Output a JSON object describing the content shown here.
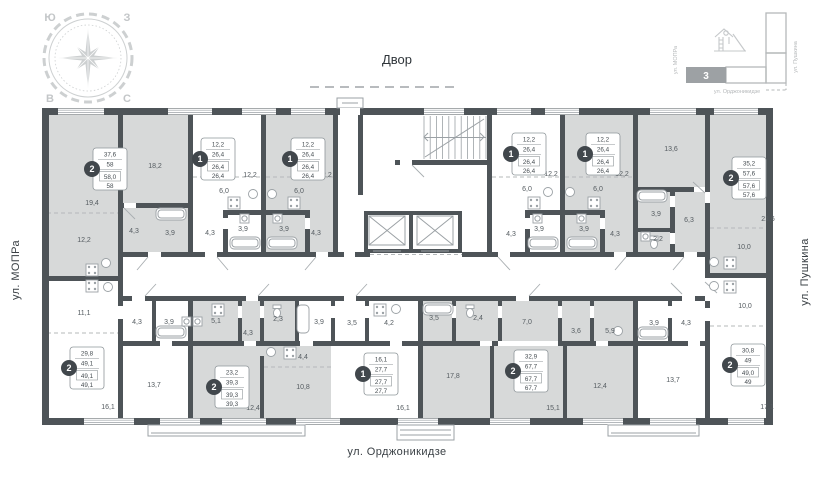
{
  "colors": {
    "wall": "#4e5458",
    "room_highlight": "#d7d9d9",
    "fixture_line": "#9ba1a5",
    "label_text": "#555c61",
    "accent_dark": "#41474c",
    "compass": "#cdd0d1",
    "minimap_fill": "#9da1a4"
  },
  "compass": {
    "nw": "Ю",
    "ne": "З",
    "sw": "В",
    "se": "С"
  },
  "labels": {
    "courtyard": "Двор",
    "street_left": "ул. МОПРа",
    "street_right": "ул. Пушкина",
    "street_bottom": "ул. Орджоникидзе"
  },
  "site_map": {
    "section_number": "3",
    "street_left": "ул. МОПРа",
    "street_right": "ул. Пушкина",
    "street_bottom": "ул. Орджоникидзе"
  },
  "plan": {
    "room_labels": [
      {
        "t": "19,4",
        "x": 92,
        "y": 205
      },
      {
        "t": "12,2",
        "x": 84,
        "y": 242
      },
      {
        "t": "18,2",
        "x": 155,
        "y": 168
      },
      {
        "t": "4,3",
        "x": 134,
        "y": 233
      },
      {
        "t": "3,9",
        "x": 170,
        "y": 235
      },
      {
        "t": "12,2",
        "x": 250,
        "y": 177
      },
      {
        "t": "6,0",
        "x": 224,
        "y": 193
      },
      {
        "t": "4,3",
        "x": 210,
        "y": 235
      },
      {
        "t": "3,9",
        "x": 243,
        "y": 231
      },
      {
        "t": "12,2",
        "x": 325,
        "y": 177
      },
      {
        "t": "6,0",
        "x": 299,
        "y": 193
      },
      {
        "t": "3,9",
        "x": 284,
        "y": 231
      },
      {
        "t": "4,3",
        "x": 316,
        "y": 235
      },
      {
        "t": "12,2",
        "x": 551,
        "y": 176
      },
      {
        "t": "6,0",
        "x": 527,
        "y": 191
      },
      {
        "t": "4,3",
        "x": 511,
        "y": 236
      },
      {
        "t": "3,9",
        "x": 539,
        "y": 231
      },
      {
        "t": "12,2",
        "x": 622,
        "y": 176
      },
      {
        "t": "6,0",
        "x": 598,
        "y": 191
      },
      {
        "t": "3,9",
        "x": 584,
        "y": 231
      },
      {
        "t": "4,3",
        "x": 615,
        "y": 236
      },
      {
        "t": "13,6",
        "x": 671,
        "y": 151
      },
      {
        "t": "3,9",
        "x": 656,
        "y": 216
      },
      {
        "t": "6,3",
        "x": 689,
        "y": 222
      },
      {
        "t": "2,2",
        "x": 658,
        "y": 241
      },
      {
        "t": "21,6",
        "x": 768,
        "y": 221
      },
      {
        "t": "10,0",
        "x": 744,
        "y": 249
      },
      {
        "t": "11,1",
        "x": 84,
        "y": 315
      },
      {
        "t": "4,3",
        "x": 137,
        "y": 324
      },
      {
        "t": "3,9",
        "x": 169,
        "y": 324
      },
      {
        "t": "5,1",
        "x": 216,
        "y": 323
      },
      {
        "t": "16,1",
        "x": 108,
        "y": 409
      },
      {
        "t": "13,7",
        "x": 154,
        "y": 387
      },
      {
        "t": "4,3",
        "x": 248,
        "y": 335
      },
      {
        "t": "2,3",
        "x": 278,
        "y": 321
      },
      {
        "t": "3,9",
        "x": 319,
        "y": 324
      },
      {
        "t": "4,4",
        "x": 303,
        "y": 359
      },
      {
        "t": "10,8",
        "x": 303,
        "y": 389
      },
      {
        "t": "12,4",
        "x": 253,
        "y": 410
      },
      {
        "t": "3,5",
        "x": 352,
        "y": 325
      },
      {
        "t": "4,2",
        "x": 389,
        "y": 325
      },
      {
        "t": "16,1",
        "x": 403,
        "y": 410
      },
      {
        "t": "3,5",
        "x": 434,
        "y": 320
      },
      {
        "t": "2,4",
        "x": 478,
        "y": 320
      },
      {
        "t": "7,0",
        "x": 527,
        "y": 324
      },
      {
        "t": "3,6",
        "x": 576,
        "y": 333
      },
      {
        "t": "5,9",
        "x": 610,
        "y": 333
      },
      {
        "t": "17,8",
        "x": 453,
        "y": 378
      },
      {
        "t": "15,1",
        "x": 553,
        "y": 410
      },
      {
        "t": "12,4",
        "x": 600,
        "y": 388
      },
      {
        "t": "3,9",
        "x": 654,
        "y": 325
      },
      {
        "t": "4,3",
        "x": 686,
        "y": 325
      },
      {
        "t": "10,0",
        "x": 745,
        "y": 308
      },
      {
        "t": "13,7",
        "x": 673,
        "y": 382
      },
      {
        "t": "17,1",
        "x": 767,
        "y": 409
      }
    ],
    "apartments": [
      {
        "x": 93,
        "y": 148,
        "n": "2",
        "rows": [
          "37,6",
          "58",
          "58,0",
          "58"
        ]
      },
      {
        "x": 201,
        "y": 138,
        "n": "1",
        "rows": [
          "12,2",
          "26,4",
          "26,4",
          "26,4"
        ]
      },
      {
        "x": 291,
        "y": 138,
        "n": "1",
        "rows": [
          "12,2",
          "26,4",
          "26,4",
          "26,4"
        ]
      },
      {
        "x": 512,
        "y": 133,
        "n": "1",
        "rows": [
          "12,2",
          "26,4",
          "26,4",
          "26,4"
        ]
      },
      {
        "x": 586,
        "y": 133,
        "n": "1",
        "rows": [
          "12,2",
          "26,4",
          "26,4",
          "26,4"
        ]
      },
      {
        "x": 732,
        "y": 157,
        "n": "2",
        "rows": [
          "35,2",
          "57,6",
          "57,6",
          "57,6"
        ]
      },
      {
        "x": 70,
        "y": 347,
        "n": "2",
        "rows": [
          "29,8",
          "49,1",
          "49,1",
          "49,1"
        ]
      },
      {
        "x": 215,
        "y": 366,
        "n": "2",
        "rows": [
          "23,2",
          "39,3",
          "39,3",
          "39,3"
        ]
      },
      {
        "x": 364,
        "y": 353,
        "n": "1",
        "rows": [
          "16,1",
          "27,7",
          "27,7",
          "27,7"
        ]
      },
      {
        "x": 514,
        "y": 350,
        "n": "2",
        "rows": [
          "32,9",
          "67,7",
          "67,7",
          "67,7"
        ]
      },
      {
        "x": 731,
        "y": 344,
        "n": "2",
        "rows": [
          "30,8",
          "49",
          "49,0",
          "49"
        ]
      }
    ]
  }
}
